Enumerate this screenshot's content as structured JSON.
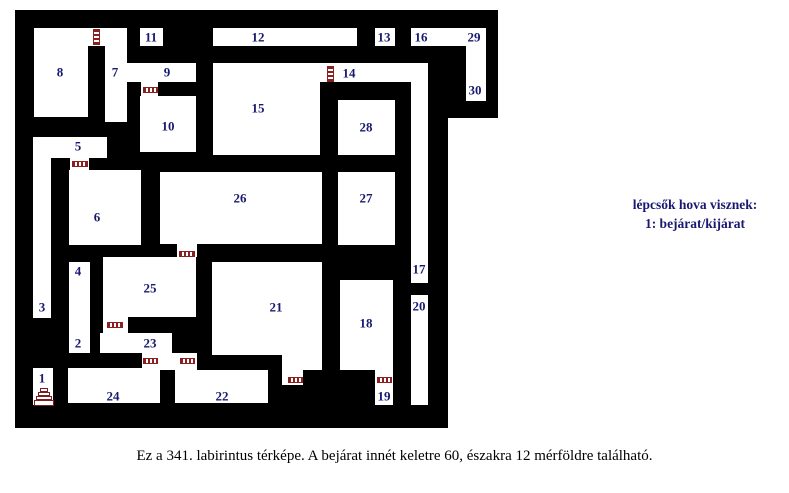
{
  "legend": {
    "line1": "lépcsők hova visznek:",
    "line2": "1: bejárat/kijárat"
  },
  "caption": "Ez a 341. labirintus térképe. A bejárat innét keletre 60, északra 12 mérföldre található.",
  "colors": {
    "wall": "#000000",
    "room": "#ffffff",
    "number_label": "#191970",
    "door": "#8b2020",
    "stairs": "#7a1f1f"
  },
  "maze": {
    "blocks": [
      {
        "x": 15,
        "y": 10,
        "w": 433,
        "h": 418
      },
      {
        "x": 448,
        "y": 10,
        "w": 50,
        "h": 108
      }
    ],
    "rooms": [
      {
        "x": 34,
        "y": 28,
        "w": 93,
        "h": 18
      },
      {
        "x": 34,
        "y": 46,
        "w": 54,
        "h": 71
      },
      {
        "x": 105,
        "y": 46,
        "w": 22,
        "h": 76
      },
      {
        "x": 140,
        "y": 28,
        "w": 23,
        "h": 18
      },
      {
        "x": 127,
        "y": 63,
        "w": 69,
        "h": 19
      },
      {
        "x": 141,
        "y": 82,
        "w": 17,
        "h": 14
      },
      {
        "x": 140,
        "y": 96,
        "w": 56,
        "h": 56
      },
      {
        "x": 213,
        "y": 28,
        "w": 144,
        "h": 18
      },
      {
        "x": 375,
        "y": 28,
        "w": 20,
        "h": 18
      },
      {
        "x": 411,
        "y": 28,
        "w": 75,
        "h": 18
      },
      {
        "x": 466,
        "y": 28,
        "w": 20,
        "h": 73
      },
      {
        "x": 213,
        "y": 63,
        "w": 107,
        "h": 92
      },
      {
        "x": 305,
        "y": 63,
        "w": 123,
        "h": 19
      },
      {
        "x": 411,
        "y": 63,
        "w": 17,
        "h": 220
      },
      {
        "x": 338,
        "y": 100,
        "w": 57,
        "h": 55
      },
      {
        "x": 160,
        "y": 172,
        "w": 162,
        "h": 72
      },
      {
        "x": 338,
        "y": 172,
        "w": 57,
        "h": 73
      },
      {
        "x": 33,
        "y": 137,
        "w": 74,
        "h": 21
      },
      {
        "x": 70,
        "y": 158,
        "w": 19,
        "h": 14
      },
      {
        "x": 69,
        "y": 170,
        "w": 72,
        "h": 75
      },
      {
        "x": 33,
        "y": 158,
        "w": 18,
        "h": 160
      },
      {
        "x": 69,
        "y": 262,
        "w": 21,
        "h": 91
      },
      {
        "x": 177,
        "y": 243,
        "w": 20,
        "h": 14
      },
      {
        "x": 103,
        "y": 257,
        "w": 93,
        "h": 60
      },
      {
        "x": 103,
        "y": 317,
        "w": 25,
        "h": 16
      },
      {
        "x": 100,
        "y": 333,
        "w": 72,
        "h": 20
      },
      {
        "x": 142,
        "y": 353,
        "w": 55,
        "h": 17
      },
      {
        "x": 68,
        "y": 368,
        "w": 92,
        "h": 35
      },
      {
        "x": 33,
        "y": 368,
        "w": 20,
        "h": 37
      },
      {
        "x": 175,
        "y": 370,
        "w": 93,
        "h": 33
      },
      {
        "x": 212,
        "y": 262,
        "w": 110,
        "h": 93
      },
      {
        "x": 282,
        "y": 355,
        "w": 40,
        "h": 15
      },
      {
        "x": 282,
        "y": 370,
        "w": 21,
        "h": 15
      },
      {
        "x": 340,
        "y": 280,
        "w": 53,
        "h": 90
      },
      {
        "x": 375,
        "y": 370,
        "w": 18,
        "h": 35
      },
      {
        "x": 411,
        "y": 295,
        "w": 17,
        "h": 110
      }
    ],
    "labels": [
      {
        "n": "1",
        "x": 42,
        "y": 378
      },
      {
        "n": "2",
        "x": 78,
        "y": 343
      },
      {
        "n": "3",
        "x": 42,
        "y": 307
      },
      {
        "n": "4",
        "x": 78,
        "y": 271
      },
      {
        "n": "5",
        "x": 78,
        "y": 146
      },
      {
        "n": "6",
        "x": 97,
        "y": 217
      },
      {
        "n": "7",
        "x": 115,
        "y": 72
      },
      {
        "n": "8",
        "x": 60,
        "y": 72
      },
      {
        "n": "9",
        "x": 167,
        "y": 72
      },
      {
        "n": "10",
        "x": 168,
        "y": 126
      },
      {
        "n": "11",
        "x": 151,
        "y": 37
      },
      {
        "n": "12",
        "x": 258,
        "y": 37
      },
      {
        "n": "13",
        "x": 384,
        "y": 37
      },
      {
        "n": "14",
        "x": 349,
        "y": 73
      },
      {
        "n": "15",
        "x": 258,
        "y": 108
      },
      {
        "n": "16",
        "x": 421,
        "y": 37
      },
      {
        "n": "17",
        "x": 419,
        "y": 269
      },
      {
        "n": "18",
        "x": 366,
        "y": 323
      },
      {
        "n": "19",
        "x": 384,
        "y": 396
      },
      {
        "n": "20",
        "x": 419,
        "y": 306
      },
      {
        "n": "21",
        "x": 276,
        "y": 307
      },
      {
        "n": "22",
        "x": 222,
        "y": 396
      },
      {
        "n": "23",
        "x": 150,
        "y": 343
      },
      {
        "n": "24",
        "x": 113,
        "y": 396
      },
      {
        "n": "25",
        "x": 150,
        "y": 288
      },
      {
        "n": "26",
        "x": 240,
        "y": 198
      },
      {
        "n": "27",
        "x": 366,
        "y": 198
      },
      {
        "n": "28",
        "x": 366,
        "y": 127
      },
      {
        "n": "29",
        "x": 474,
        "y": 37
      },
      {
        "n": "30",
        "x": 475,
        "y": 90
      }
    ],
    "doors": [
      {
        "dir": "v",
        "x": 93,
        "y": 29,
        "w": 7,
        "h": 16
      },
      {
        "dir": "h",
        "x": 143,
        "y": 87,
        "w": 15,
        "h": 6
      },
      {
        "dir": "v",
        "x": 327,
        "y": 66,
        "w": 7,
        "h": 16
      },
      {
        "dir": "h",
        "x": 72,
        "y": 161,
        "w": 16,
        "h": 6
      },
      {
        "dir": "h",
        "x": 179,
        "y": 251,
        "w": 16,
        "h": 6
      },
      {
        "dir": "h",
        "x": 107,
        "y": 322,
        "w": 16,
        "h": 6
      },
      {
        "dir": "h",
        "x": 143,
        "y": 358,
        "w": 15,
        "h": 6
      },
      {
        "dir": "h",
        "x": 180,
        "y": 358,
        "w": 15,
        "h": 6
      },
      {
        "dir": "h",
        "x": 288,
        "y": 377,
        "w": 15,
        "h": 6
      },
      {
        "dir": "h",
        "x": 377,
        "y": 377,
        "w": 15,
        "h": 6
      }
    ],
    "stairs": {
      "x": 34,
      "y": 388,
      "w": 20,
      "h": 18,
      "steps": [
        [
          8,
          4
        ],
        [
          12,
          4
        ],
        [
          16,
          4
        ],
        [
          20,
          6
        ]
      ]
    }
  }
}
